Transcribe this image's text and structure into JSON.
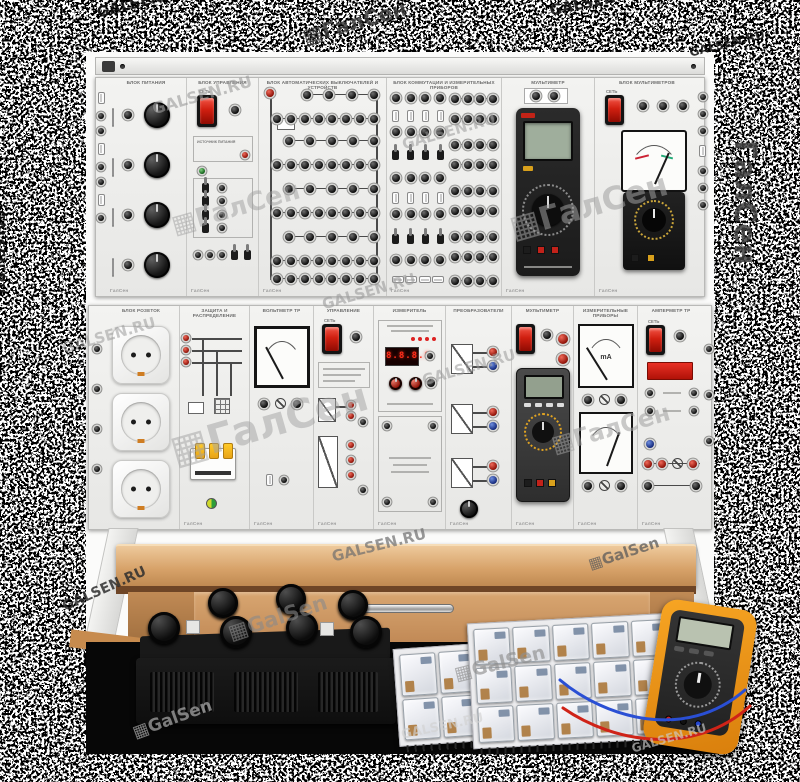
{
  "watermark": {
    "site": "GALSEN.RU",
    "brand": "ГалСен",
    "brand_latin": "GalSen",
    "logo_glyph": "▦",
    "items": [
      {
        "text": "GALSEN.RU"
      },
      {
        "text": "▦ГалСен"
      },
      {
        "text": "GALSEN.RU"
      },
      {
        "text": "GALSEN.RU"
      },
      {
        "text": "GALSEN.RU"
      },
      {
        "text": "ГалСен"
      },
      {
        "text": "GALSEN.RU"
      },
      {
        "text": "GALSEN.RU"
      },
      {
        "text": "▦ГалСен"
      },
      {
        "text": "▦ГалСен"
      },
      {
        "text": "GALSEN.RU"
      },
      {
        "text": "GALSEN.RU"
      },
      {
        "text": "▦ГалСен"
      },
      {
        "text": "GALSEN.RU"
      },
      {
        "text": "▦ГалСен"
      },
      {
        "text": "GALSEN.RU"
      },
      {
        "text": "GALSEN.RU"
      },
      {
        "text": "▦GalSen"
      },
      {
        "text": "▦GalSen"
      },
      {
        "text": "▦GalSen"
      },
      {
        "text": "▦GalSen"
      },
      {
        "text": "GALSEN.RU"
      },
      {
        "text": "GALSEN.RU"
      }
    ]
  },
  "brand": {
    "small_logo": "ГалСен"
  },
  "top_panel": {
    "power_block": {
      "header": "БЛОК ПИТАНИЯ"
    },
    "control_block": {
      "header": "БЛОК УПРАВЛЕНИЯ",
      "power_label": "СЕТЬ",
      "sub1": "ИСТОЧНИК ПИТАНИЯ"
    },
    "patch_block": {
      "header": "БЛОК АВТОМАТИЧЕСКИХ ВЫКЛЮЧАТЕЛЕЙ И УСТРОЙСТВ"
    },
    "switch_block": {
      "header": "БЛОК КОММУТАЦИИ И ИЗМЕРИТЕЛЬНЫХ ПРИБОРОВ"
    },
    "dmm_block": {
      "header": "МУЛЬТИМЕТР"
    },
    "multimeter_block": {
      "header": "БЛОК МУЛЬТИМЕТРОВ",
      "power_label": "СЕТЬ"
    }
  },
  "bottom_panel": {
    "sockets_block": {
      "header": "БЛОК РОЗЕТОК"
    },
    "breaker_block": {
      "header": "ЗАЩИТА И РАСПРЕДЕЛЕНИЕ"
    },
    "voltmeter_block": {
      "header": "ВОЛЬТМЕТР ТР"
    },
    "regulator_block": {
      "header": "УПРАВЛЕНИЕ",
      "power_label": "СЕТЬ"
    },
    "indicator_block": {
      "header": "ИЗМЕРИТЕЛЬ",
      "display_value": "8.8.8.8"
    },
    "converter_block": {
      "header": "ПРЕОБРАЗОВАТЕЛИ"
    },
    "mm2_block": {
      "header": "МУЛЬТИМЕТР",
      "power_label": "СЕТЬ"
    },
    "meters_block": {
      "header": "ИЗМЕРИТЕЛЬНЫЕ ПРИБОРЫ",
      "meter1_unit": "mA"
    },
    "ammeter_block": {
      "header": "АМПЕРМЕТР ТР",
      "power_label": "СЕТЬ"
    }
  },
  "colors": {
    "accent_red": "#c6231a",
    "led_red": "#ff2d1a",
    "panel": "#eeeeec",
    "wood": "#c9965f",
    "meter_yellow": "#ef9416",
    "relay_board": "#e9e9ea"
  }
}
